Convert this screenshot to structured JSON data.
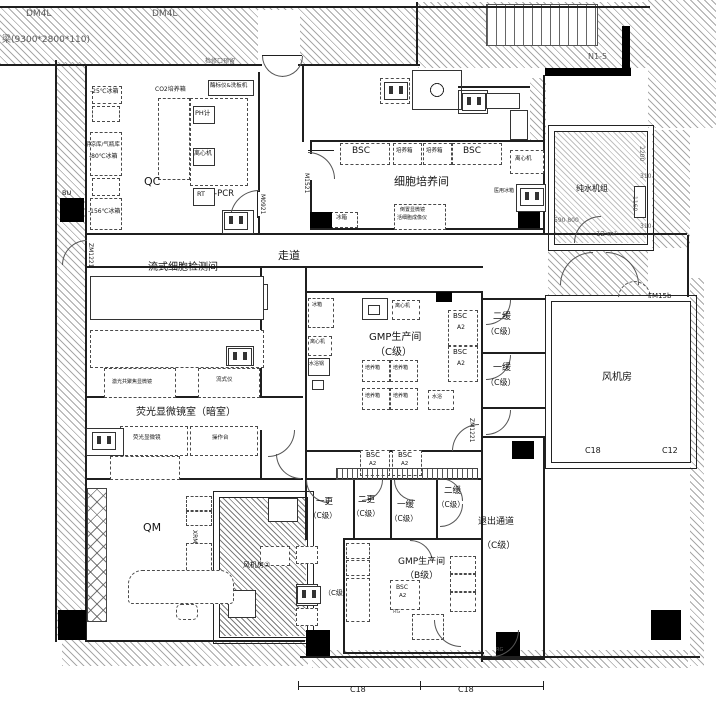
{
  "plan": {
    "labels": [
      {
        "id": "dim-dm4l-1",
        "t": "DM4L",
        "x": 26,
        "y": 10,
        "fs": 9,
        "c": "dim"
      },
      {
        "id": "dim-dm4l-2",
        "t": "DM4L",
        "x": 152,
        "y": 10,
        "fs": 9,
        "c": "dim"
      },
      {
        "id": "dim-beam",
        "t": "梁(9300*2800*110)",
        "x": 2,
        "y": 36,
        "fs": 9,
        "c": "dim"
      },
      {
        "id": "stair-n1-5",
        "t": "N1-5",
        "x": 588,
        "y": 53,
        "fs": 8,
        "c": "dim"
      },
      {
        "id": "note-access",
        "t": "检修口预留",
        "x": 205,
        "y": 59,
        "fs": 6,
        "c": "dim"
      },
      {
        "id": "room-qc",
        "t": "QC",
        "x": 144,
        "y": 176,
        "fs": 11
      },
      {
        "id": "eq-f25",
        "t": "-25℃冰箱",
        "x": 90,
        "y": 89,
        "fs": 6
      },
      {
        "id": "eq-co2",
        "t": "CO2培养箱",
        "x": 155,
        "y": 87,
        "fs": 6
      },
      {
        "id": "eq-plate-reader",
        "t": "酶标仪&洗板机",
        "x": 210,
        "y": 84,
        "fs": 5.5
      },
      {
        "id": "eq-ph",
        "t": "PH计",
        "x": 195,
        "y": 110,
        "fs": 6.5
      },
      {
        "id": "eq-centrifuge-1",
        "t": "离心机",
        "x": 194,
        "y": 151,
        "fs": 6
      },
      {
        "id": "eq-rt",
        "t": "RT",
        "x": 197,
        "y": 191,
        "fs": 6.5
      },
      {
        "id": "eq-pcr",
        "t": "-PCR",
        "x": 214,
        "y": 190,
        "fs": 8.5
      },
      {
        "id": "eq-coolroom",
        "t": "阴凉库/气瓶库",
        "x": 85,
        "y": 143,
        "fs": 5.5
      },
      {
        "id": "eq-f80",
        "t": "-80℃冰箱",
        "x": 89,
        "y": 154,
        "fs": 6
      },
      {
        "id": "eq-f156",
        "t": "-156℃冰箱",
        "x": 88,
        "y": 209,
        "fs": 6
      },
      {
        "id": "col-bu",
        "t": "BU",
        "x": 62,
        "y": 190,
        "fs": 6.5
      },
      {
        "id": "door-zm1221-left",
        "t": "ZM1221",
        "x": 87,
        "y": 243,
        "fs": 6,
        "v": 1
      },
      {
        "id": "door-m0921",
        "t": "M0921",
        "x": 259,
        "y": 194,
        "fs": 6,
        "v": 1
      },
      {
        "id": "door-m1521",
        "t": "M1521",
        "x": 303,
        "y": 173,
        "fs": 6,
        "v": 1
      },
      {
        "id": "room-cell-culture",
        "t": "细胞培养间",
        "x": 394,
        "y": 176,
        "fs": 11
      },
      {
        "id": "eq-bsc-1",
        "t": "BSC",
        "x": 352,
        "y": 147,
        "fs": 9
      },
      {
        "id": "eq-incubator-1",
        "t": "培养箱",
        "x": 396,
        "y": 149,
        "fs": 5.5
      },
      {
        "id": "eq-incubator-2",
        "t": "培养箱",
        "x": 426,
        "y": 149,
        "fs": 5.5
      },
      {
        "id": "eq-bsc-2",
        "t": "BSC",
        "x": 463,
        "y": 147,
        "fs": 9
      },
      {
        "id": "eq-centrifuge-2",
        "t": "离心机",
        "x": 515,
        "y": 157,
        "fs": 5.5
      },
      {
        "id": "eq-med-fridge",
        "t": "医用冰箱",
        "x": 494,
        "y": 189,
        "fs": 5
      },
      {
        "id": "eq-inverted-scope",
        "t": "倒置显微镜",
        "x": 400,
        "y": 208,
        "fs": 5
      },
      {
        "id": "eq-live-cell",
        "t": "活细胞成像仪",
        "x": 397,
        "y": 216,
        "fs": 5
      },
      {
        "id": "eq-fridge-1",
        "t": "冰箱",
        "x": 336,
        "y": 216,
        "fs": 5.5
      },
      {
        "id": "corridor",
        "t": "走道",
        "x": 278,
        "y": 250,
        "fs": 11
      },
      {
        "id": "room-flow",
        "t": "流式细胞检测间",
        "x": 148,
        "y": 263,
        "fs": 10
      },
      {
        "id": "eq-confocal",
        "t": "激光共聚焦显微镜",
        "x": 112,
        "y": 380,
        "fs": 5
      },
      {
        "id": "eq-flow-cytometer",
        "t": "流式仪",
        "x": 216,
        "y": 378,
        "fs": 5.5
      },
      {
        "id": "room-fluorescence",
        "t": "荧光显微镜室（暗室）",
        "x": 136,
        "y": 408,
        "fs": 10
      },
      {
        "id": "eq-fluor-scope",
        "t": "荧光显微镜",
        "x": 133,
        "y": 436,
        "fs": 5.5
      },
      {
        "id": "eq-bench-1",
        "t": "操作台",
        "x": 212,
        "y": 436,
        "fs": 5.5
      },
      {
        "id": "room-qm",
        "t": "QM",
        "x": 143,
        "y": 522,
        "fs": 11
      },
      {
        "id": "label-xrm",
        "t": "XRM",
        "x": 191,
        "y": 530,
        "fs": 6,
        "v": 1
      },
      {
        "id": "room-fan-2",
        "t": "风机房②",
        "x": 243,
        "y": 562,
        "fs": 7
      },
      {
        "id": "room-gmp-c",
        "t": "GMP生产间",
        "x": 369,
        "y": 333,
        "fs": 10
      },
      {
        "id": "room-gmp-c-grade",
        "t": "（C级）",
        "x": 375,
        "y": 348,
        "fs": 10
      },
      {
        "id": "eq-bsc-3",
        "t": "BSC",
        "x": 453,
        "y": 313,
        "fs": 7
      },
      {
        "id": "eq-bsc-3-a2",
        "t": "A2",
        "x": 457,
        "y": 325,
        "fs": 6
      },
      {
        "id": "eq-bsc-4",
        "t": "BSC",
        "x": 453,
        "y": 349,
        "fs": 7
      },
      {
        "id": "eq-bsc-4-a2",
        "t": "A2",
        "x": 457,
        "y": 361,
        "fs": 6
      },
      {
        "id": "room-buffer2",
        "t": "二缓",
        "x": 493,
        "y": 313,
        "fs": 9
      },
      {
        "id": "room-buffer2-grade",
        "t": "（C级）",
        "x": 486,
        "y": 328,
        "fs": 8
      },
      {
        "id": "room-buffer1",
        "t": "一缓",
        "x": 493,
        "y": 364,
        "fs": 9
      },
      {
        "id": "room-buffer1-grade",
        "t": "（C级）",
        "x": 486,
        "y": 379,
        "fs": 8
      },
      {
        "id": "door-zm1221-right",
        "t": "ZM1221",
        "x": 468,
        "y": 418,
        "fs": 6,
        "v": 1
      },
      {
        "id": "room-fan-1",
        "t": "风机房",
        "x": 602,
        "y": 373,
        "fs": 10
      },
      {
        "id": "grid-c18-a",
        "t": "C18",
        "x": 585,
        "y": 447,
        "fs": 8
      },
      {
        "id": "grid-c12",
        "t": "C12",
        "x": 662,
        "y": 447,
        "fs": 8
      },
      {
        "id": "door-fm15b",
        "t": "FM15b",
        "x": 648,
        "y": 293,
        "fs": 7
      },
      {
        "id": "room-water-unit",
        "t": "纯水机组",
        "x": 576,
        "y": 185,
        "fs": 8
      },
      {
        "id": "dim-2200",
        "t": "2200",
        "x": 638,
        "y": 146,
        "fs": 6,
        "v": 1,
        "c": "dim"
      },
      {
        "id": "dim-310-a",
        "t": "310",
        "x": 640,
        "y": 174,
        "fs": 6,
        "c": "dim"
      },
      {
        "id": "dim-1160",
        "t": "1160",
        "x": 631,
        "y": 196,
        "fs": 6,
        "v": 1,
        "c": "dim"
      },
      {
        "id": "dim-310-b",
        "t": "310",
        "x": 640,
        "y": 224,
        "fs": 6,
        "c": "dim"
      },
      {
        "id": "dim-590-800",
        "t": "590  800",
        "x": 554,
        "y": 218,
        "fs": 6,
        "c": "dim"
      },
      {
        "id": "dim-area",
        "t": "12 m²",
        "x": 596,
        "y": 231,
        "fs": 7,
        "c": "dim"
      },
      {
        "id": "room-change1",
        "t": "一更",
        "x": 316,
        "y": 498,
        "fs": 8.5
      },
      {
        "id": "room-change1-grade",
        "t": "（C级）",
        "x": 309,
        "y": 512,
        "fs": 7.5
      },
      {
        "id": "room-change2",
        "t": "二更",
        "x": 358,
        "y": 496,
        "fs": 8.5
      },
      {
        "id": "room-change2-grade",
        "t": "（C级）",
        "x": 352,
        "y": 510,
        "fs": 7.5
      },
      {
        "id": "room-airlock1",
        "t": "一缓",
        "x": 397,
        "y": 501,
        "fs": 8.5
      },
      {
        "id": "room-airlock1-grade",
        "t": "（C级）",
        "x": 390,
        "y": 515,
        "fs": 7.5
      },
      {
        "id": "room-airlock2",
        "t": "二缓",
        "x": 444,
        "y": 487,
        "fs": 8.5
      },
      {
        "id": "room-airlock2-grade",
        "t": "（C级）",
        "x": 437,
        "y": 501,
        "fs": 7.5
      },
      {
        "id": "room-exit-corridor",
        "t": "退出通道",
        "x": 478,
        "y": 518,
        "fs": 9
      },
      {
        "id": "room-exit-grade",
        "t": "（C级）",
        "x": 482,
        "y": 542,
        "fs": 9
      },
      {
        "id": "room-gmp-b",
        "t": "GMP生产间",
        "x": 398,
        "y": 558,
        "fs": 9
      },
      {
        "id": "room-gmp-b-grade",
        "t": "（B级）",
        "x": 405,
        "y": 572,
        "fs": 9
      },
      {
        "id": "eq-bsc-5",
        "t": "BSC",
        "x": 396,
        "y": 585,
        "fs": 6
      },
      {
        "id": "eq-bsc-5-a2",
        "t": "A2",
        "x": 399,
        "y": 594,
        "fs": 5.5
      },
      {
        "id": "room-c-grade-b",
        "t": "（C级）",
        "x": 324,
        "y": 590,
        "fs": 7
      },
      {
        "id": "mark-rg-1",
        "t": "RG",
        "x": 393,
        "y": 610,
        "fs": 5,
        "c": "dim"
      },
      {
        "id": "mark-rg-2",
        "t": "RG",
        "x": 496,
        "y": 648,
        "fs": 5,
        "c": "dim"
      },
      {
        "id": "grid-c18-b",
        "t": "C18",
        "x": 350,
        "y": 686,
        "fs": 8
      },
      {
        "id": "grid-c18-c",
        "t": "C18",
        "x": 458,
        "y": 686,
        "fs": 8
      },
      {
        "id": "eq-bsc-6",
        "t": "BSC",
        "x": 366,
        "y": 452,
        "fs": 7
      },
      {
        "id": "eq-bsc-6-a2",
        "t": "A2",
        "x": 369,
        "y": 462,
        "fs": 5.5
      },
      {
        "id": "eq-bsc-7",
        "t": "BSC",
        "x": 398,
        "y": 452,
        "fs": 7
      },
      {
        "id": "eq-bsc-7-a2",
        "t": "A2",
        "x": 401,
        "y": 462,
        "fs": 5.5
      },
      {
        "id": "eq-incubator-3",
        "t": "培养箱",
        "x": 365,
        "y": 366,
        "fs": 5
      },
      {
        "id": "eq-incubator-4",
        "t": "培养箱",
        "x": 393,
        "y": 366,
        "fs": 5
      },
      {
        "id": "eq-incubator-5",
        "t": "培养箱",
        "x": 365,
        "y": 394,
        "fs": 5
      },
      {
        "id": "eq-incubator-6",
        "t": "培养箱",
        "x": 393,
        "y": 394,
        "fs": 5
      },
      {
        "id": "eq-waterbath-1",
        "t": "水浴",
        "x": 432,
        "y": 395,
        "fs": 5
      },
      {
        "id": "eq-centrifuge-3",
        "t": "离心机",
        "x": 395,
        "y": 304,
        "fs": 5
      },
      {
        "id": "eq-fridge-2",
        "t": "冰箱",
        "x": 312,
        "y": 303,
        "fs": 5
      },
      {
        "id": "eq-centrifuge-4",
        "t": "离心机",
        "x": 310,
        "y": 340,
        "fs": 5
      },
      {
        "id": "eq-waterbath-2",
        "t": "水浴锅",
        "x": 309,
        "y": 362,
        "fs": 5
      }
    ]
  }
}
